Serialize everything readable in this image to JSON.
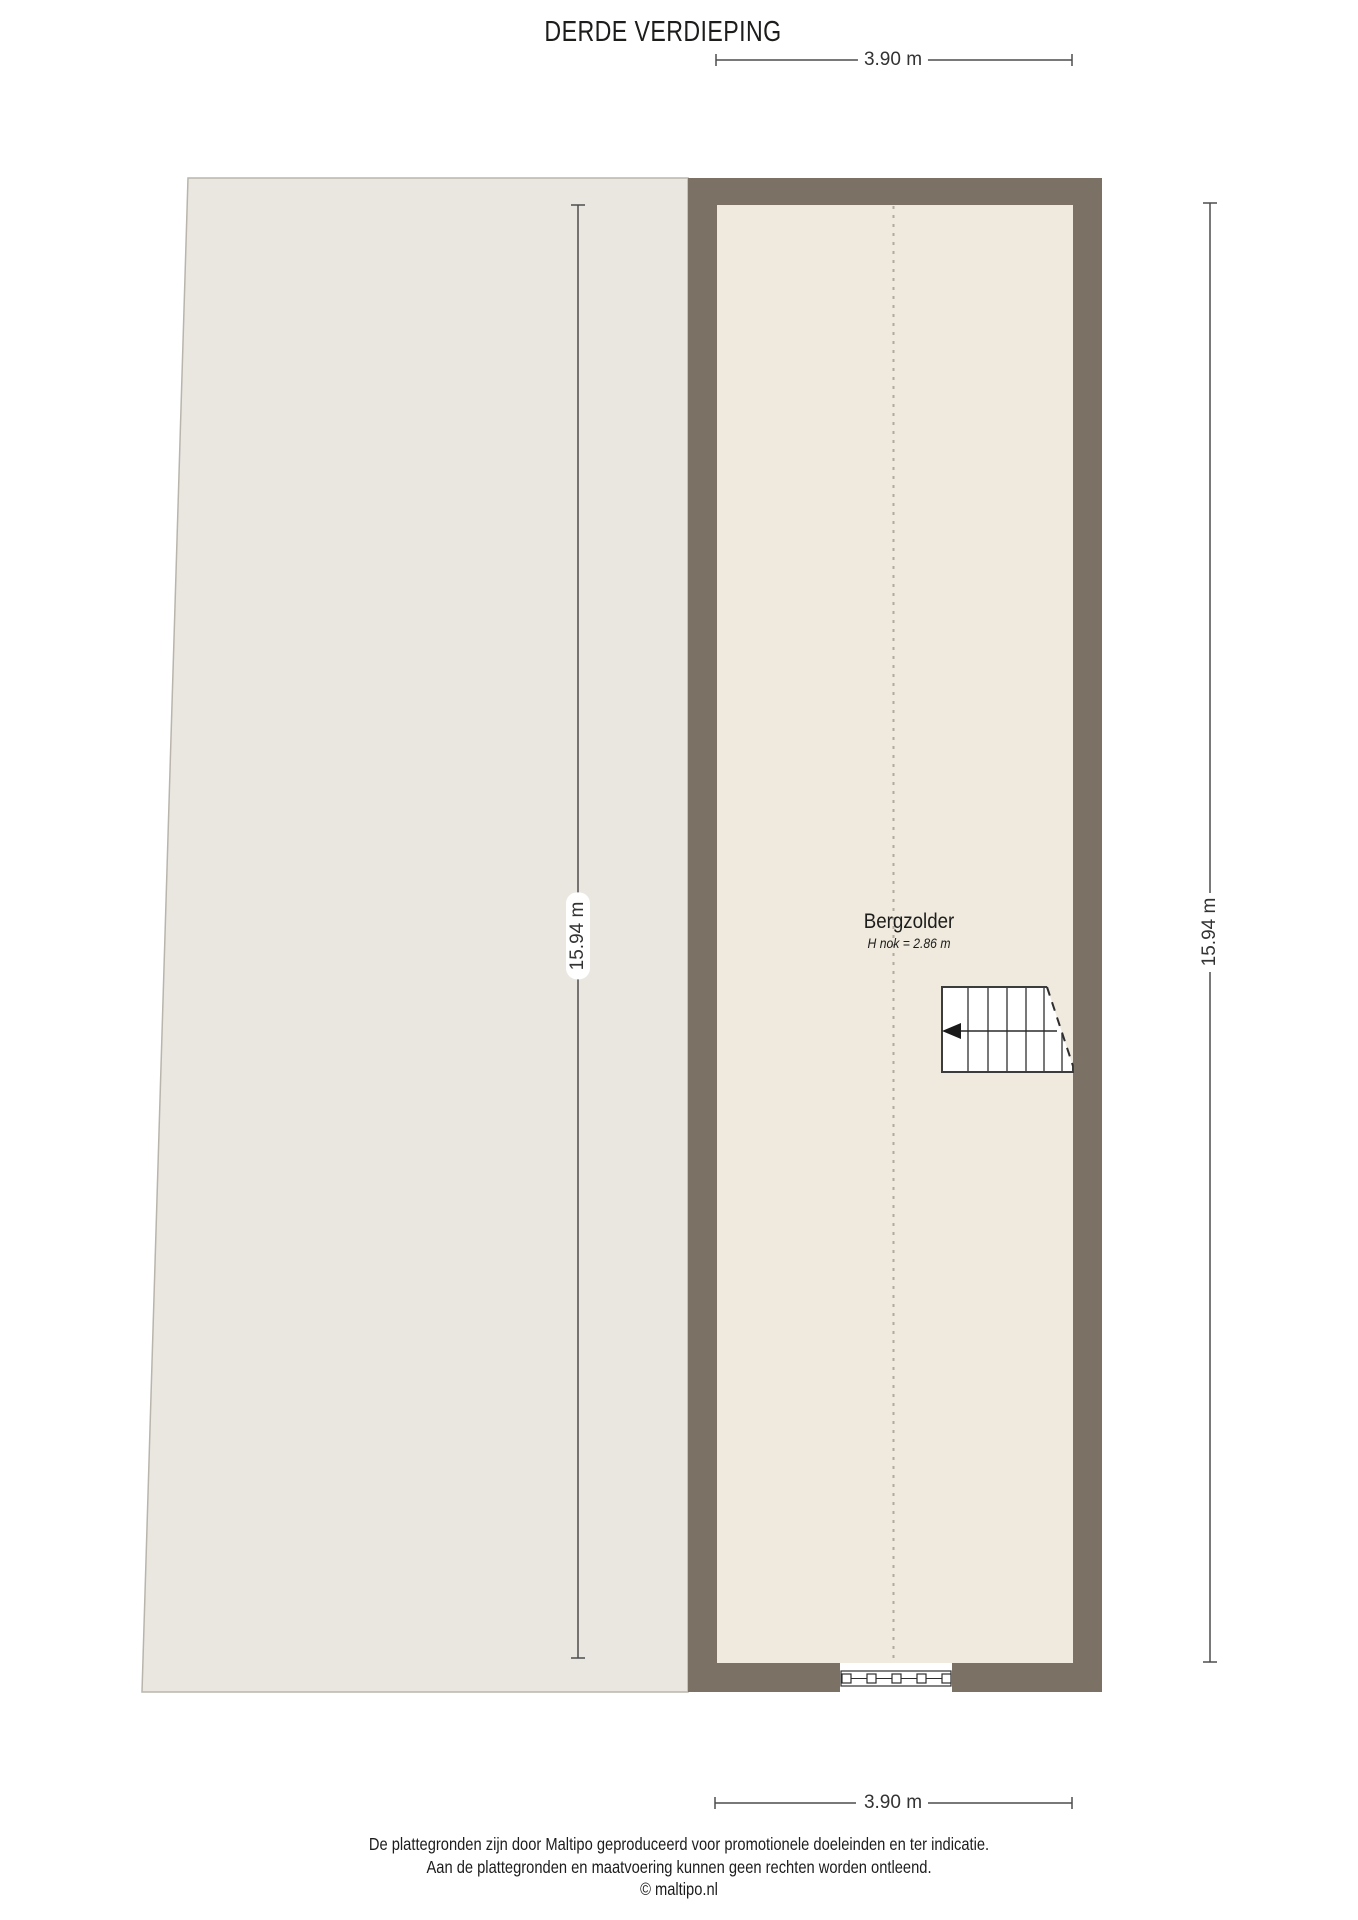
{
  "page": {
    "title": "DERDE VERDIEPING"
  },
  "dimensions": {
    "top_width": "3.90 m",
    "bottom_width": "3.90 m",
    "left_height": "15.94 m",
    "right_height": "15.94 m"
  },
  "room": {
    "name": "Bergzolder",
    "height_note": "H nok = 2.86 m"
  },
  "footer": {
    "line1": "De plattegronden zijn door Maltipo geproduceerd voor promotionele doeleinden en ter indicatie.",
    "line2": "Aan de plattegronden en maatvoering kunnen geen rechten worden ontleend.",
    "line3": "© maltipo.nl"
  },
  "colors": {
    "wall": "#7b7265",
    "room_fill": "#efe9de",
    "roof_fill": "#eae7e1"
  }
}
